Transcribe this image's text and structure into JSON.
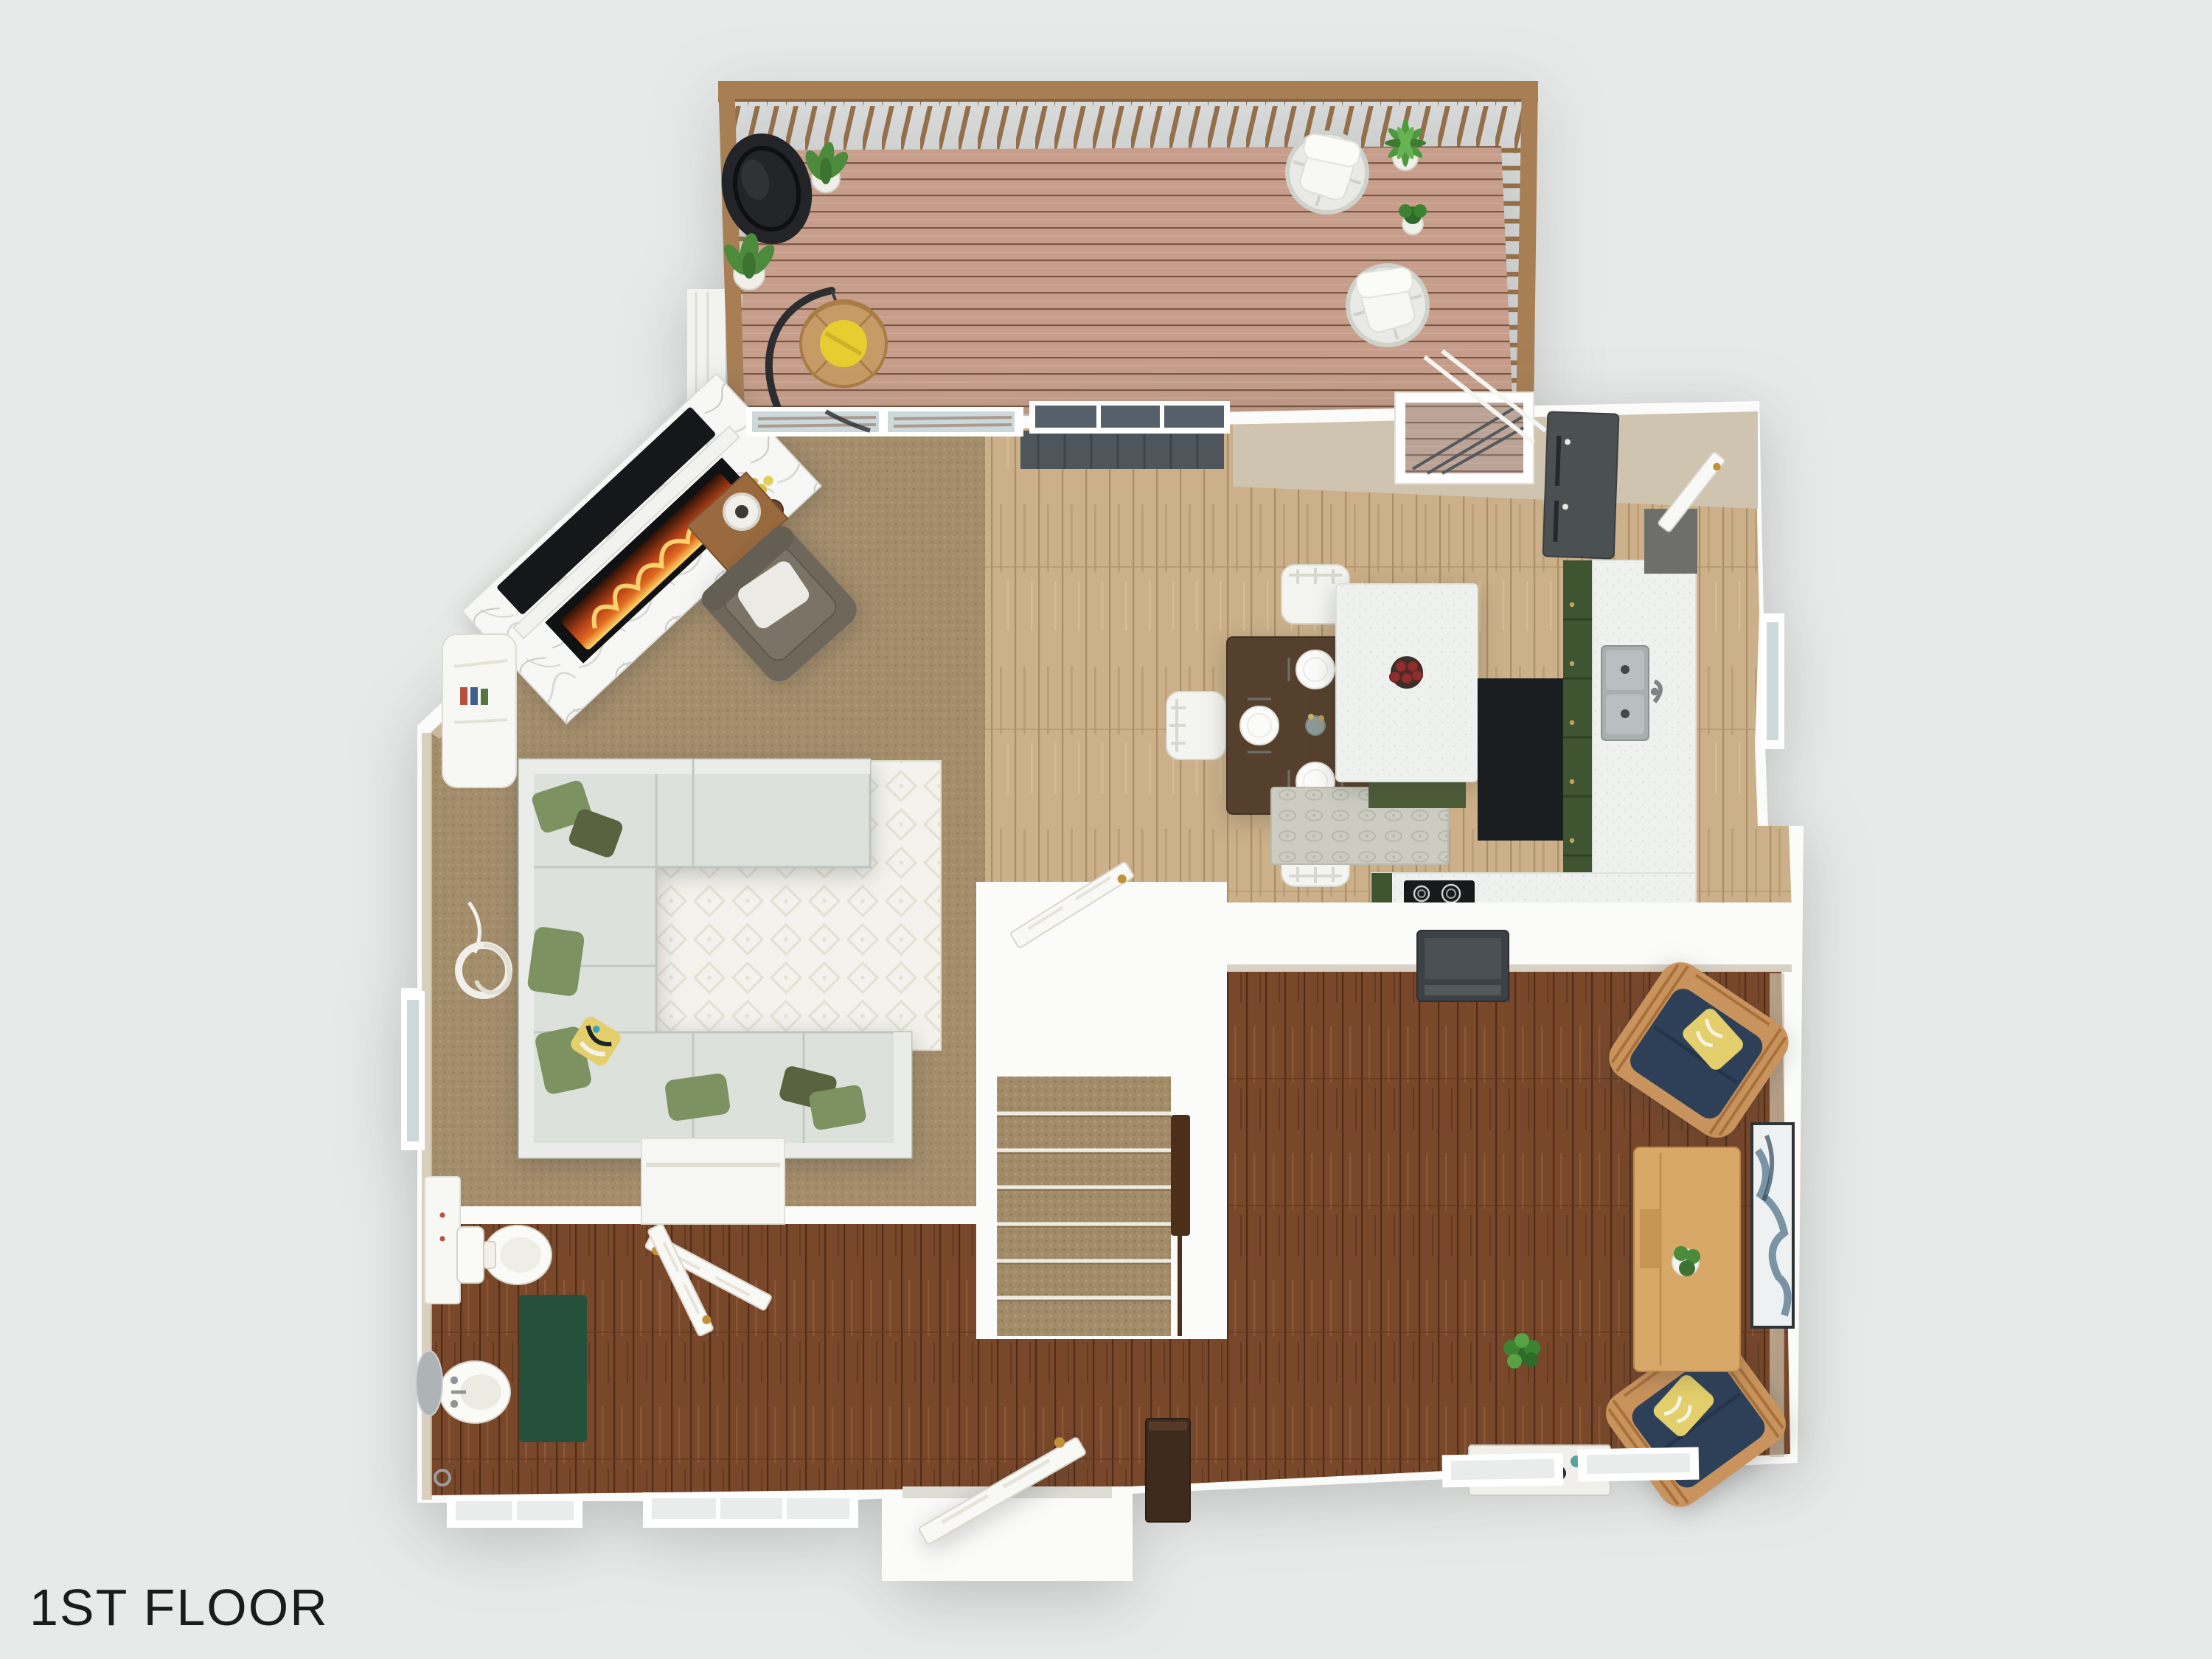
{
  "title": {
    "label": "1ST FLOOR"
  },
  "palette": {
    "background": "#e8eaea",
    "wall_white": "#fbfbf9",
    "wall_face": "#cfc4af",
    "carpet": "#a38d6b",
    "wood_light": "#cbb089",
    "wood_dark": "#79472a",
    "deck_wood": "#c69e8b",
    "deck_rail": "#a87f55",
    "sofa": "#dde1dc",
    "pillow_green": "#7c9260",
    "pillow_olive": "#5a6340",
    "pillow_yellow": "#e3cf6b",
    "rug_living": "#f3f2ec",
    "rug_runner": "#ccccc2",
    "rug_bath": "#24503c",
    "table_dark": "#54402d",
    "chair_white": "#f4f4f1",
    "island_green": "#4c5d37",
    "cabinet_green": "#3f5531",
    "counter_white": "#eff1ee",
    "appliance_gray": "#4b5053",
    "cooktop_black": "#171a1c",
    "tv_gray": "#3c4145",
    "chair_navy": "#2d4058",
    "chair_frame": "#c8935c",
    "desk_wood": "#d8a868",
    "mat_gray": "#4e565c",
    "glass": "#cdd8da",
    "fire_orange": "#e06b1f",
    "door_knob_gold": "#c09136",
    "text_dark": "#1b1b1b"
  },
  "scene": {
    "type": "3d-floor-plan-render",
    "floor": "1ST FLOOR",
    "rooms": [
      {
        "name": "deck",
        "floor_finish": "wood-planks",
        "items": [
          "round-black-lounge-chair",
          "potted-plant",
          "potted-plant",
          "hanging-egg-chair-yellow-cushion",
          "white-wicker-swivel-chair",
          "white-wicker-swivel-chair",
          "palm-plant",
          "small-potted-plant",
          "wood-railing",
          "outdoor-stairs"
        ]
      },
      {
        "name": "living-room",
        "floor_finish": "tan-carpet",
        "items": [
          "corner-fireplace-marble",
          "wall-tv",
          "brown-armchair-white-pillow",
          "wood-side-table",
          "table-lamp",
          "sectional-sofa-light-gray",
          "green-throw-pillows",
          "patterned-area-rug-white",
          "spiral-floor-lamp",
          "white-console",
          "decor-vases"
        ]
      },
      {
        "name": "dining-room",
        "floor_finish": "light-wood",
        "items": [
          "square-dark-wood-table",
          "four-white-chairs",
          "four-place-settings",
          "sliding-glass-door",
          "dark-entry-mat"
        ]
      },
      {
        "name": "kitchen",
        "floor_finish": "light-wood",
        "items": [
          "kitchen-island-white-top-green-base",
          "bowl-of-apples",
          "double-stainless-sink",
          "green-cabinets",
          "white-countertop",
          "dark-refrigerator",
          "black-counter-section",
          "electric-cooktop",
          "gray-runner-rug",
          "pantry-door",
          "window"
        ]
      },
      {
        "name": "family-room",
        "floor_finish": "dark-hardwood",
        "items": [
          "half-wall-tv",
          "navy-armchair-wood-frame",
          "navy-armchair-wood-frame",
          "yellow-throw-pillows",
          "wood-desk-console",
          "potted-plant",
          "leaning-wall-art",
          "floor-art",
          "shoe-cabinet"
        ]
      },
      {
        "name": "stair-hall",
        "floor_finish": "dark-hardwood",
        "items": [
          "carpeted-staircase",
          "newel-post",
          "open-white-door",
          "entry-door-open",
          "closet-open-door"
        ]
      },
      {
        "name": "bathroom",
        "floor_finish": "dark-hardwood",
        "items": [
          "toilet",
          "pedestal-sink",
          "round-mirror",
          "green-rug",
          "wall-cabinet",
          "towel-ring",
          "open-door",
          "window"
        ]
      }
    ]
  }
}
